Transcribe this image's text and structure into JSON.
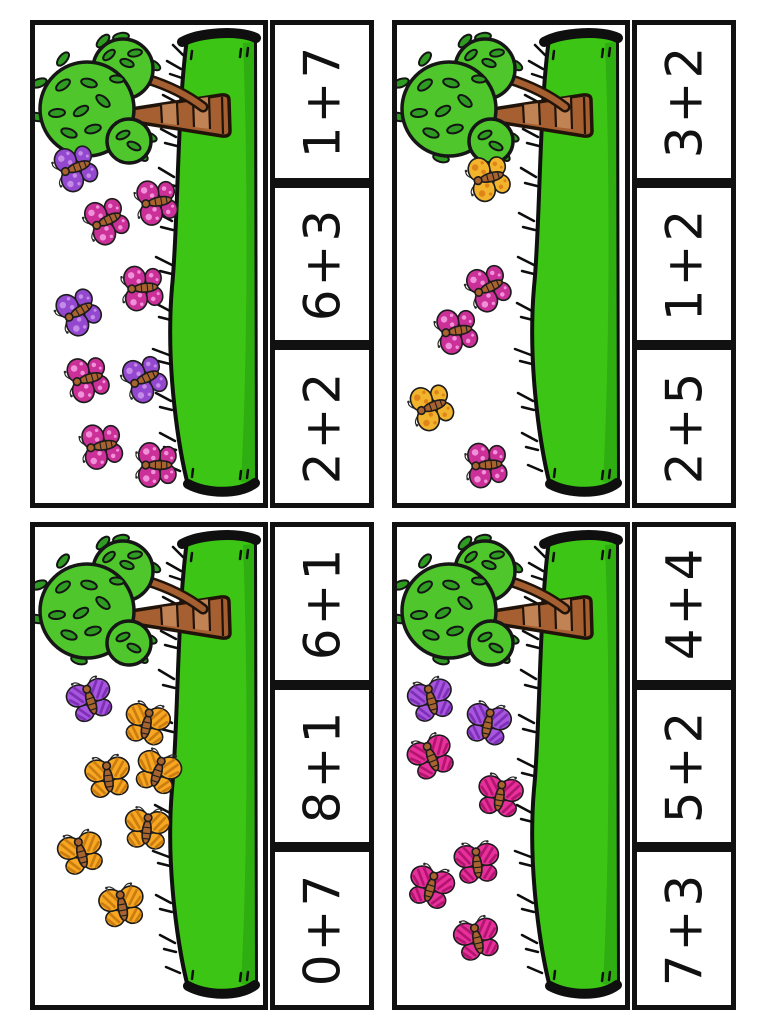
{
  "page": {
    "background": "#ffffff"
  },
  "palette": {
    "card_border": "#111111",
    "equation_text": "#111111",
    "grass": "#3cc515",
    "grass_shade": "#2eae10",
    "grass_outline": "#0f0f0f",
    "foliage": "#4ec62c",
    "leaf": "#2f9b22",
    "trunk": "#a55f30",
    "trunk_light": "#c28354",
    "trunk_outline": "#20130a",
    "butterfly": {
      "pink_spotted": {
        "wing": "#cb3098",
        "accent": "#f090d8",
        "body": "#a9632f"
      },
      "purple_spotted": {
        "wing": "#9448d0",
        "accent": "#c48ae8",
        "body": "#a9632f"
      },
      "yellow_spotted": {
        "wing": "#f2b42c",
        "accent": "#df8418",
        "body": "#a9632f"
      },
      "orange_striped": {
        "wing": "#f7a722",
        "accent": "#cc7d10",
        "body": "#a9632f"
      },
      "pink_striped": {
        "wing": "#e8309c",
        "accent": "#b3156e",
        "body": "#a9632f"
      },
      "purple_striped": {
        "wing": "#a855e0",
        "accent": "#7d2fb5",
        "body": "#a9632f"
      }
    }
  },
  "cards": [
    {
      "id": "top-left",
      "equations": [
        "1+7",
        "6+3",
        "2+2"
      ],
      "butterflies": [
        {
          "color": "purple_spotted",
          "x": 17.5,
          "y": 30,
          "rotate": -110
        },
        {
          "color": "pink_spotted",
          "x": 31,
          "y": 41,
          "rotate": -115
        },
        {
          "color": "pink_spotted",
          "x": 53,
          "y": 37,
          "rotate": -100
        },
        {
          "color": "pink_spotted",
          "x": 47,
          "y": 55,
          "rotate": -95
        },
        {
          "color": "purple_spotted",
          "x": 19,
          "y": 60,
          "rotate": -120
        },
        {
          "color": "pink_spotted",
          "x": 23,
          "y": 74,
          "rotate": -105
        },
        {
          "color": "purple_spotted",
          "x": 48,
          "y": 74,
          "rotate": -115
        },
        {
          "color": "pink_spotted",
          "x": 29,
          "y": 88,
          "rotate": -100
        },
        {
          "color": "pink_spotted",
          "x": 53,
          "y": 92,
          "rotate": -90
        }
      ]
    },
    {
      "id": "top-right",
      "equations": [
        "3+2",
        "1+2",
        "2+5"
      ],
      "butterflies": [
        {
          "color": "yellow_spotted",
          "x": 40,
          "y": 32,
          "rotate": -105
        },
        {
          "color": "pink_spotted",
          "x": 40,
          "y": 55,
          "rotate": -115
        },
        {
          "color": "pink_spotted",
          "x": 26,
          "y": 64,
          "rotate": -100
        },
        {
          "color": "yellow_spotted",
          "x": 15,
          "y": 80,
          "rotate": -110
        },
        {
          "color": "pink_spotted",
          "x": 39,
          "y": 92,
          "rotate": -95
        }
      ]
    },
    {
      "id": "bottom-left",
      "equations": [
        "6+1",
        "8+1",
        "0+7"
      ],
      "butterflies": [
        {
          "color": "purple_striped",
          "x": 24,
          "y": 36,
          "rotate": -18
        },
        {
          "color": "orange_striped",
          "x": 49,
          "y": 41,
          "rotate": 12
        },
        {
          "color": "orange_striped",
          "x": 32,
          "y": 52,
          "rotate": -8
        },
        {
          "color": "orange_striped",
          "x": 54,
          "y": 51,
          "rotate": 18
        },
        {
          "color": "orange_striped",
          "x": 20,
          "y": 68,
          "rotate": -15
        },
        {
          "color": "orange_striped",
          "x": 49,
          "y": 63,
          "rotate": 6
        },
        {
          "color": "orange_striped",
          "x": 38,
          "y": 79,
          "rotate": -10
        }
      ]
    },
    {
      "id": "bottom-right",
      "equations": [
        "4+4",
        "5+2",
        "7+3"
      ],
      "butterflies": [
        {
          "color": "purple_striped",
          "x": 15,
          "y": 36,
          "rotate": -15
        },
        {
          "color": "purple_striped",
          "x": 40,
          "y": 41,
          "rotate": 12
        },
        {
          "color": "pink_striped",
          "x": 15,
          "y": 48,
          "rotate": -22
        },
        {
          "color": "pink_striped",
          "x": 45,
          "y": 56,
          "rotate": 10
        },
        {
          "color": "pink_striped",
          "x": 35,
          "y": 70,
          "rotate": -6
        },
        {
          "color": "pink_striped",
          "x": 15,
          "y": 75,
          "rotate": 16
        },
        {
          "color": "pink_striped",
          "x": 35,
          "y": 86,
          "rotate": -14
        }
      ]
    }
  ]
}
